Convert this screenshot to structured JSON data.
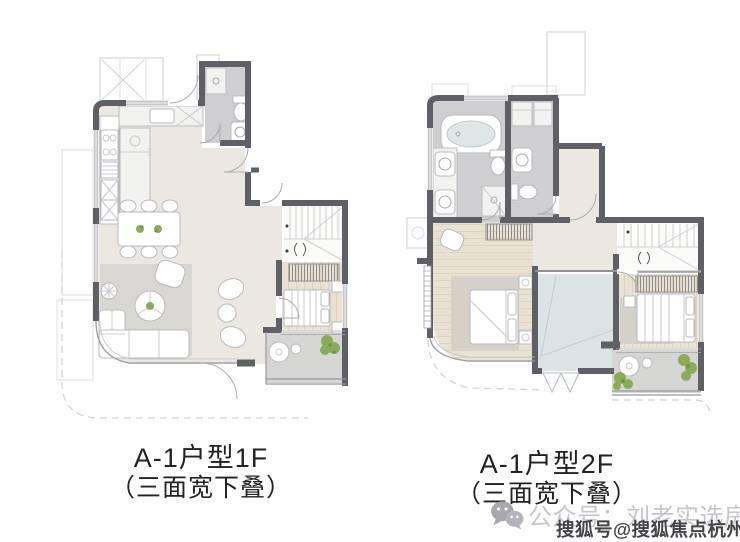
{
  "image": {
    "width": 740,
    "height": 542,
    "background": "#ffffff",
    "content": "Two floor plans of a duplex apartment unit (1F and 2F) shown side by side"
  },
  "plans": [
    {
      "id": "1f",
      "caption_line1": "A-1户型1F",
      "caption_line2": "（三面宽下叠）"
    },
    {
      "id": "2f",
      "caption_line1": "A-1户型2F",
      "caption_line2": "（三面宽下叠）"
    }
  ],
  "watermarks": {
    "wechat": {
      "icon": "wechat-logo",
      "text": "公众号：刘老实选房",
      "color": "#c6c6c6"
    },
    "sohu": {
      "text": "搜狐号@搜狐焦点杭州站",
      "color": "#43434a"
    }
  },
  "colors": {
    "wall": "#5f5f66",
    "floorMain": "#ebe8e2",
    "floorWood": "#e9e1d2",
    "floorBath": "#cfcfd1",
    "floorBalcony": "#d5d6d4",
    "floorVoid": "#dce3e5",
    "rug": "#d8d7d3",
    "rug2": "#d5d1c9",
    "plant": "#8aab58",
    "caption": "#222222",
    "wmLight": "#c6c6c6",
    "wmDark": "#43434a"
  }
}
